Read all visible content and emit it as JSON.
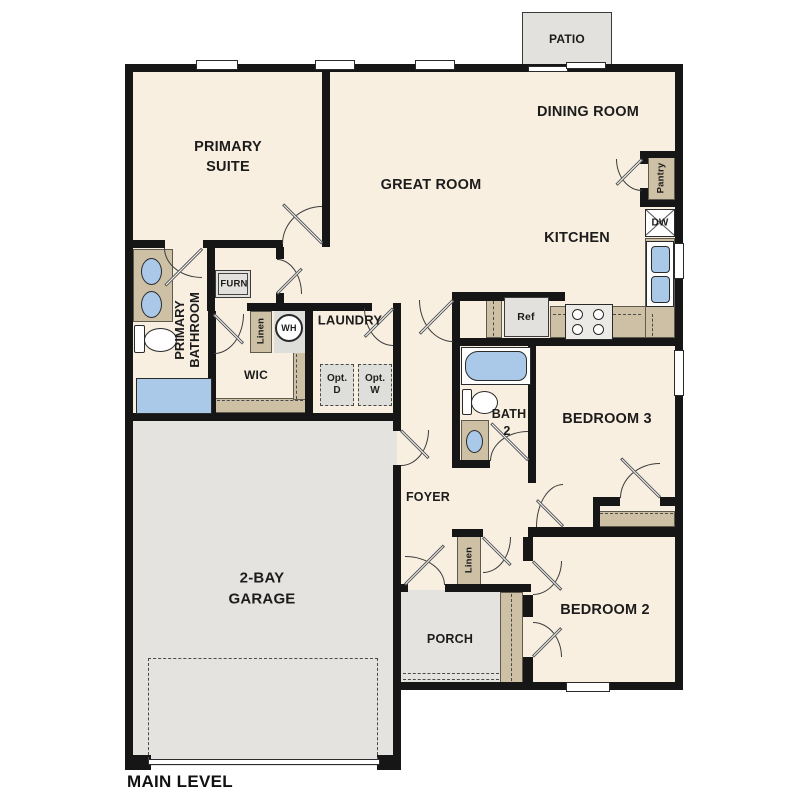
{
  "plan_title": "MAIN LEVEL",
  "rooms": {
    "patio": "PATIO",
    "dining_room": "DINING ROOM",
    "great_room": "GREAT ROOM",
    "kitchen": "KITCHEN",
    "primary_suite": [
      "PRIMARY",
      "SUITE"
    ],
    "primary_bathroom": [
      "PRIMARY",
      "BATHROOM"
    ],
    "wic": "WIC",
    "laundry": "LAUNDRY",
    "bath2": [
      "BATH",
      "2"
    ],
    "bedroom3": "BEDROOM 3",
    "foyer": "FOYER",
    "bedroom2": "BEDROOM 2",
    "garage": [
      "2-BAY",
      "GARAGE"
    ],
    "porch": "PORCH"
  },
  "fixtures": {
    "pantry": "Pantry",
    "dishwasher": "DW",
    "refrigerator": "Ref",
    "furnace": "FURN",
    "water_heater": "WH",
    "linen_hall": "Linen",
    "linen_foyer": "Linen",
    "optional_dryer": [
      "Opt.",
      "D"
    ],
    "optional_washer": [
      "Opt.",
      "W"
    ]
  },
  "colors": {
    "floor_cream": "#f8efe0",
    "wall_black": "#161616",
    "cabinet_tan": "#cdc0a5",
    "fixture_blue": "#aac9e9",
    "garage_gray": "#e4e3e0",
    "appliance_gray": "#e2e1de"
  }
}
